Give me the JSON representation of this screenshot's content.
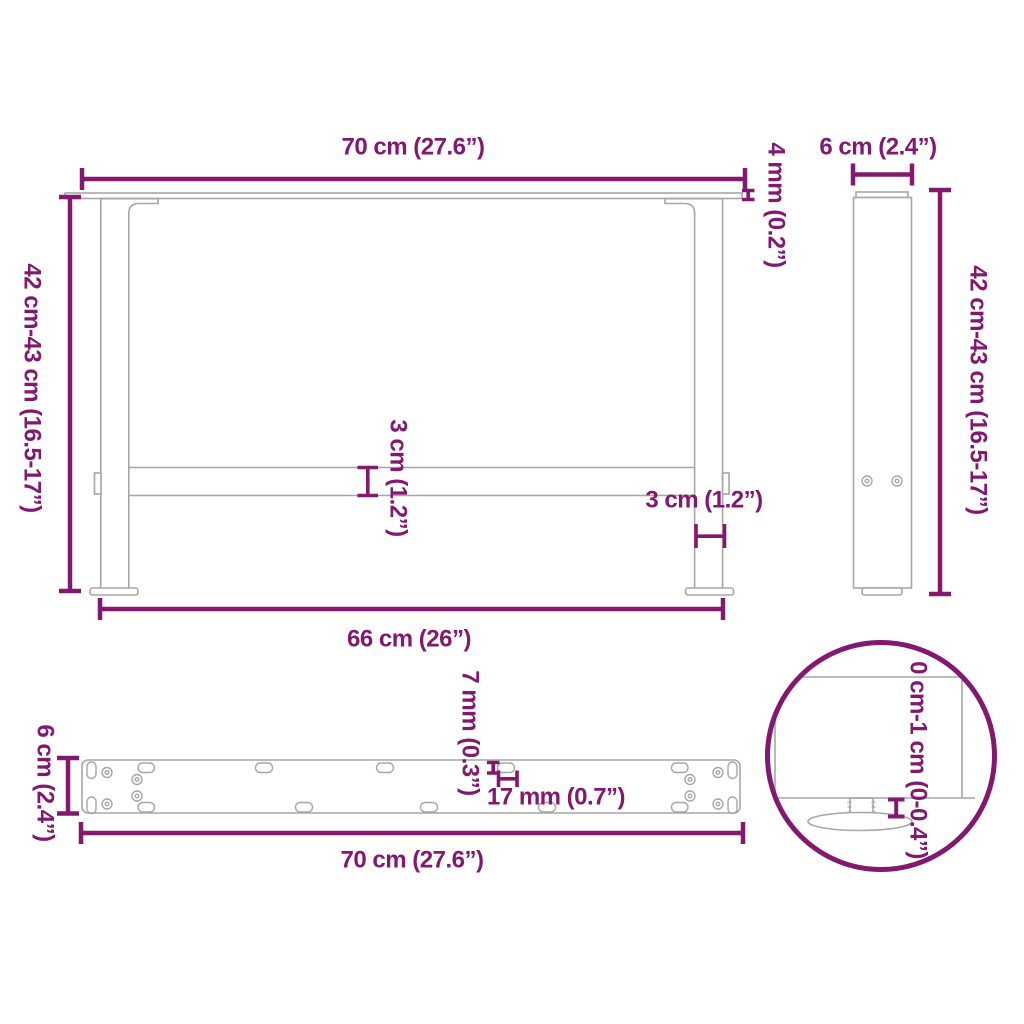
{
  "colors": {
    "dimension_accent": "#821870",
    "drawing_gray": "#a6a6a6",
    "background": "#ffffff"
  },
  "views": {
    "front": {
      "labels": {
        "top_width": "70 cm (27.6”)",
        "height": "42 cm-43 cm (16.5-17”)",
        "top_plate_thickness": "4 mm (0.2”)",
        "crossbar_thickness": "3 cm (1.2”)",
        "leg_thickness": "3 cm (1.2”)",
        "bottom_width": "66 cm (26”)"
      }
    },
    "side": {
      "labels": {
        "depth": "6 cm (2.4”)",
        "height": "42 cm-43 cm (16.5-17”)"
      }
    },
    "plate": {
      "labels": {
        "depth": "6 cm (2.4”)",
        "width": "70 cm (27.6”)",
        "slot_width": "7 mm (0.3”)",
        "slot_length": "17 mm (0.7”)"
      }
    },
    "detail": {
      "labels": {
        "foot_adjustment_range": "0 cm-1 cm (0-0.4”)"
      }
    }
  }
}
